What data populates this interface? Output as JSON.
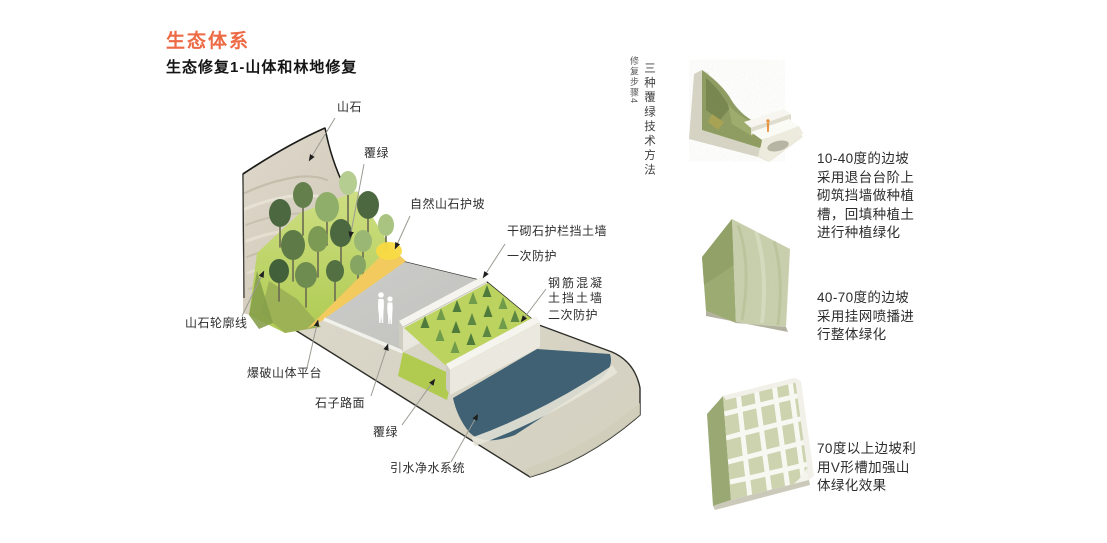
{
  "header": {
    "title": "生态体系",
    "subtitle": "生态修复1-山体和林地修复"
  },
  "diagram": {
    "labels": [
      {
        "text": "山石"
      },
      {
        "text": "覆绿"
      },
      {
        "text": "自然山石护坡"
      },
      {
        "text": "干砌石护栏挡土墙"
      },
      {
        "text": "一次防护"
      },
      {
        "text": "钢筋混凝\n土挡土墙"
      },
      {
        "text": "二次防护"
      },
      {
        "text": "山石轮廓线"
      },
      {
        "text": "爆破山体平台"
      },
      {
        "text": "石子路面"
      },
      {
        "text": "覆绿"
      },
      {
        "text": "引水净水系统"
      }
    ]
  },
  "side_note": {
    "step_label": "修复步骤4",
    "method_title": "三种覆绿技术方法"
  },
  "methods": [
    {
      "name": "terrace-planting",
      "description": "10-40度的边坡\n采用退台台阶上\n砌筑挡墙做种植\n槽，回填种植土\n进行种植绿化"
    },
    {
      "name": "mesh-spray-seeding",
      "description": "40-70度的边坡\n采用挂网喷播进\n行整体绿化"
    },
    {
      "name": "v-groove",
      "description": "70度以上边坡利\n用V形槽加强山\n体绿化效果"
    }
  ],
  "palette": {
    "accent": "#ed6a45",
    "label_text": "#2f2f2f",
    "water": "#3f6173",
    "slope_yellow": "#f2ca5e",
    "grass_lime": "#bcd45f",
    "tree_dark": "#4c6840",
    "rock": "#d8d2c5",
    "wall": "#eae8df",
    "platform_gray": "#c7c7c3",
    "embankment": "#dcdacb",
    "base": "#d9d6c8"
  }
}
